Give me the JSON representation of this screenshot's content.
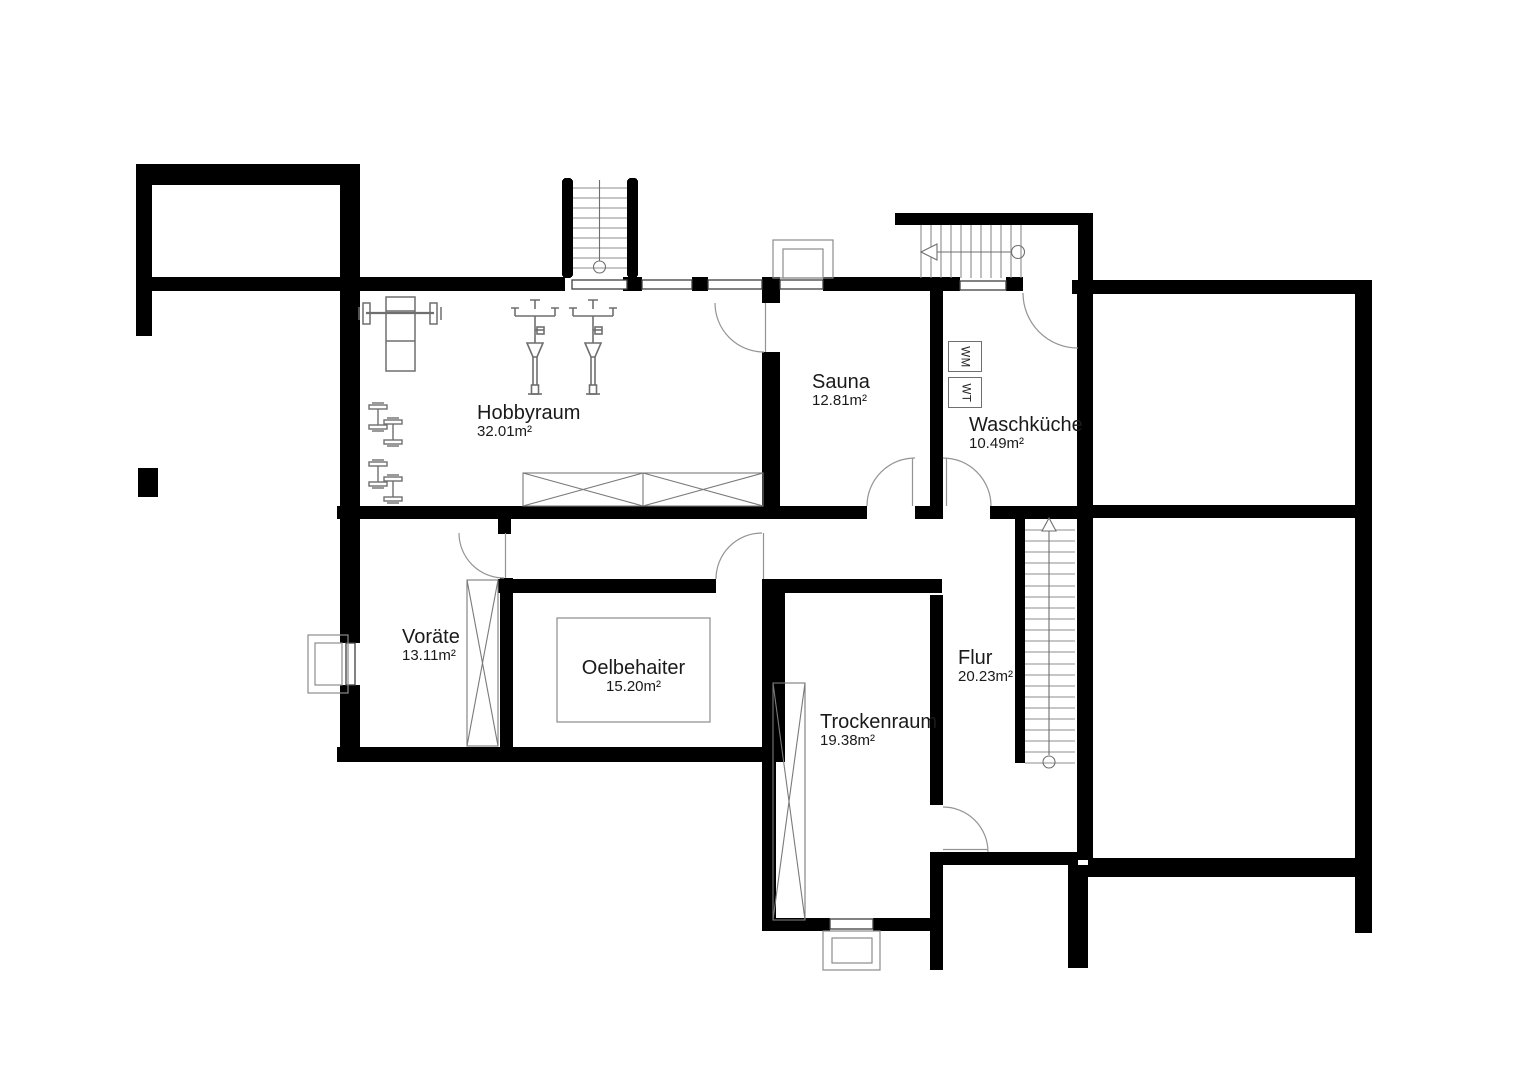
{
  "rooms": [
    {
      "id": "hobbyraum",
      "name": "Hobbyraum",
      "area": "32.01m²"
    },
    {
      "id": "sauna",
      "name": "Sauna",
      "area": "12.81m²"
    },
    {
      "id": "waschkueche",
      "name": "Waschküche",
      "area": "10.49m²"
    },
    {
      "id": "voraete",
      "name": "Voräte",
      "area": "13.11m²"
    },
    {
      "id": "oelbehaiter",
      "name": "Oelbehaiter",
      "area": "15.20m²"
    },
    {
      "id": "trockenraum",
      "name": "Trockenraum",
      "area": "19.38m²"
    },
    {
      "id": "flur",
      "name": "Flur",
      "area": "20.23m²"
    }
  ],
  "appliances": [
    {
      "id": "wm",
      "label": "WM"
    },
    {
      "id": "wt",
      "label": "WT"
    }
  ],
  "colors": {
    "wall": "#000000",
    "background": "#ffffff",
    "window_line": "#3f3f3f",
    "thin_line": "#8c8c8c",
    "text": "#1a1a1a"
  }
}
